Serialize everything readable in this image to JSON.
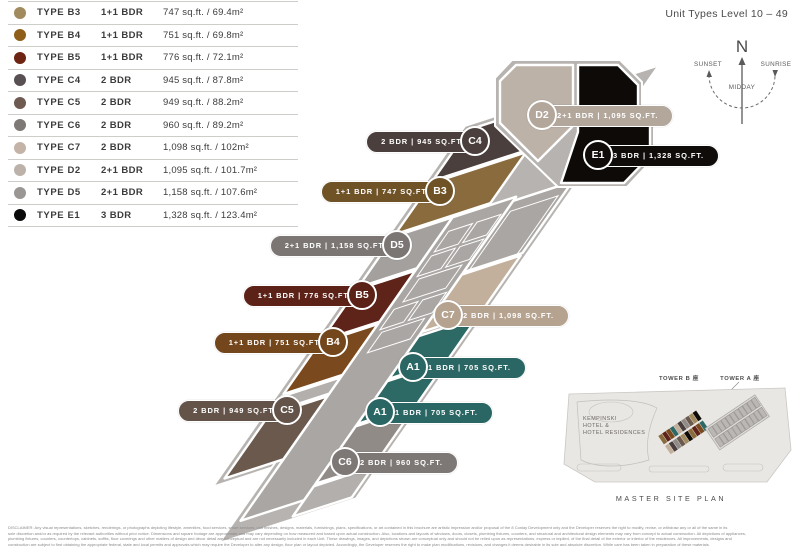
{
  "title": "Unit Types Level 10 – 49",
  "legend": {
    "rows": [
      {
        "type": "TYPE B3",
        "bdr": "1+1 BDR",
        "area": "747 sq.ft. / 69.4m²",
        "color": "#a08a5e"
      },
      {
        "type": "TYPE B4",
        "bdr": "1+1 BDR",
        "area": "751 sq.ft. / 69.8m²",
        "color": "#8f5e18"
      },
      {
        "type": "TYPE B5",
        "bdr": "1+1 BDR",
        "area": "776 sq.ft. / 72.1m²",
        "color": "#6e2413"
      },
      {
        "type": "TYPE C4",
        "bdr": "2 BDR",
        "area": "945 sq.ft. / 87.8m²",
        "color": "#585052"
      },
      {
        "type": "TYPE C5",
        "bdr": "2 BDR",
        "area": "949 sq.ft. / 88.2m²",
        "color": "#6e5a50"
      },
      {
        "type": "TYPE C6",
        "bdr": "2 BDR",
        "area": "960 sq.ft. / 89.2m²",
        "color": "#7e7876"
      },
      {
        "type": "TYPE C7",
        "bdr": "2 BDR",
        "area": "1,098 sq.ft. / 102m²",
        "color": "#c4b4a8"
      },
      {
        "type": "TYPE D2",
        "bdr": "2+1 BDR",
        "area": "1,095 sq.ft. / 101.7m²",
        "color": "#bcb2aa"
      },
      {
        "type": "TYPE D5",
        "bdr": "2+1 BDR",
        "area": "1,158 sq.ft. / 107.6m²",
        "color": "#9a9694"
      },
      {
        "type": "TYPE E1",
        "bdr": "3 BDR",
        "area": "1,328 sq.ft. / 123.4m²",
        "color": "#0a0a0a"
      }
    ]
  },
  "compass": {
    "north": "N",
    "sunset": "SUNSET",
    "sunrise": "SUNRISE",
    "midday": "MIDDAY"
  },
  "plan": {
    "outline_color": "#b7b3b0",
    "core_color": "#aaa6a3",
    "bar_pieces": [
      {
        "id": "unit-C4",
        "t0": 0,
        "t1": 62,
        "c0": 0,
        "c1": 100,
        "color": "#4a3f3c"
      },
      {
        "id": "unit-B3",
        "t0": 65,
        "t1": 127,
        "c0": 0,
        "c1": 100,
        "color": "#8a6b3e"
      },
      {
        "id": "unit-D5",
        "t0": 130,
        "t1": 192,
        "c0": 0,
        "c1": 62,
        "color": "#a3a09d"
      },
      {
        "id": "unit-B5",
        "t0": 195,
        "t1": 257,
        "c0": 0,
        "c1": 62,
        "color": "#5f2419"
      },
      {
        "id": "unit-B4",
        "t0": 260,
        "t1": 322,
        "c0": 0,
        "c1": 62,
        "color": "#7a4a1e"
      },
      {
        "id": "stair-core",
        "t0": 325,
        "t1": 345,
        "c0": 0,
        "c1": 62,
        "color": "#b3afac"
      },
      {
        "id": "unit-C5",
        "t0": 348,
        "t1": 425,
        "c0": 0,
        "c1": 62,
        "color": "#6b594d"
      },
      {
        "id": "central-core",
        "t0": 130,
        "t1": 500,
        "c0": 62,
        "c1": 129,
        "color": "#aaa6a3"
      },
      {
        "id": "core-upper-right",
        "t0": 135,
        "t1": 222,
        "c0": 129,
        "c1": 191,
        "color": "#aaa6a3"
      },
      {
        "id": "unit-C7",
        "t0": 225,
        "t1": 295,
        "c0": 129,
        "c1": 191,
        "color": "#c3b09c"
      },
      {
        "id": "unit-A1-upper",
        "t0": 300,
        "t1": 352,
        "c0": 129,
        "c1": 191,
        "color": "#2d6965"
      },
      {
        "id": "unit-A1-lower",
        "t0": 355,
        "t1": 407,
        "c0": 129,
        "c1": 191,
        "color": "#2d6965"
      },
      {
        "id": "unit-C6",
        "t0": 410,
        "t1": 480,
        "c0": 129,
        "c1": 191,
        "color": "#918b88"
      },
      {
        "id": "bar-tail",
        "t0": 483,
        "t1": 520,
        "c0": 129,
        "c1": 191,
        "color": "#b3afac"
      }
    ],
    "core_rects": [
      {
        "t0": 150,
        "t1": 175,
        "c0": 70,
        "c1": 95
      },
      {
        "t0": 150,
        "t1": 175,
        "c0": 100,
        "c1": 125
      },
      {
        "t0": 180,
        "t1": 205,
        "c0": 70,
        "c1": 95
      },
      {
        "t0": 180,
        "t1": 205,
        "c0": 100,
        "c1": 125
      },
      {
        "t0": 210,
        "t1": 238,
        "c0": 75,
        "c1": 120
      },
      {
        "t0": 245,
        "t1": 270,
        "c0": 70,
        "c1": 95
      },
      {
        "t0": 245,
        "t1": 270,
        "c0": 100,
        "c1": 125
      },
      {
        "t0": 275,
        "t1": 300,
        "c0": 75,
        "c1": 120
      },
      {
        "t0": 150,
        "t1": 222,
        "c0": 135,
        "c1": 185
      }
    ],
    "head": {
      "outline": [
        [
          512,
          60
        ],
        [
          620,
          60
        ],
        [
          642,
          82
        ],
        [
          642,
          108
        ],
        [
          654,
          120
        ],
        [
          654,
          158
        ],
        [
          627,
          187
        ],
        [
          558,
          187
        ],
        [
          495,
          126
        ],
        [
          495,
          78
        ]
      ],
      "d2": [
        [
          516,
          65
        ],
        [
          573,
          65
        ],
        [
          573,
          126
        ],
        [
          538,
          161
        ],
        [
          500,
          123
        ],
        [
          500,
          81
        ]
      ],
      "e1": [
        [
          578,
          65
        ],
        [
          618,
          65
        ],
        [
          638,
          85
        ],
        [
          638,
          110
        ],
        [
          650,
          122
        ],
        [
          650,
          156
        ],
        [
          624,
          183
        ],
        [
          561,
          183
        ],
        [
          578,
          132
        ]
      ],
      "d2_color": "#bdb2a8",
      "e1_color": "#0d0a08"
    },
    "callouts": [
      {
        "id": "C4",
        "text": "2 BDR  |  945 SQ.FT.",
        "cx": 475,
        "cy": 141,
        "side": "left",
        "color": "#4a3f3c"
      },
      {
        "id": "B3",
        "text": "1+1 BDR  |  747 SQ.FT.",
        "cx": 440,
        "cy": 191,
        "side": "left",
        "color": "#6f5226"
      },
      {
        "id": "D5",
        "text": "2+1 BDR  |  1,158 SQ.FT.",
        "cx": 397,
        "cy": 245,
        "side": "left",
        "color": "#7b7673"
      },
      {
        "id": "B5",
        "text": "1+1 BDR  |  776 SQ.FT.",
        "cx": 362,
        "cy": 295,
        "side": "left",
        "color": "#5c2218"
      },
      {
        "id": "B4",
        "text": "1+1 BDR  |  751 SQ.FT.",
        "cx": 333,
        "cy": 342,
        "side": "left",
        "color": "#74461c"
      },
      {
        "id": "C5",
        "text": "2 BDR  |  949 SQ.FT.",
        "cx": 287,
        "cy": 410,
        "side": "left",
        "color": "#635349"
      },
      {
        "id": "D2",
        "text": "2+1 BDR  |  1,095 SQ.FT.",
        "cx": 542,
        "cy": 115,
        "side": "right",
        "color": "#b3a79c"
      },
      {
        "id": "E1",
        "text": "3 BDR  |  1,328 SQ.FT.",
        "cx": 598,
        "cy": 155,
        "side": "right",
        "color": "#100c0a"
      },
      {
        "id": "C7",
        "text": "2 BDR  |  1,098 SQ.FT.",
        "cx": 448,
        "cy": 315,
        "side": "right",
        "color": "#b5a28f"
      },
      {
        "id": "A1",
        "text": "1 BDR  |  705 SQ.FT.",
        "cx": 413,
        "cy": 367,
        "side": "right",
        "color": "#2a6663"
      },
      {
        "id": "A1",
        "text": "1 BDR  |  705 SQ.FT.",
        "cx": 380,
        "cy": 412,
        "side": "right",
        "color": "#2a6663"
      },
      {
        "id": "C6",
        "text": "2 BDR  |  960 SQ.FT.",
        "cx": 345,
        "cy": 462,
        "side": "right",
        "color": "#7d7875"
      }
    ]
  },
  "site_plan": {
    "tower_b_label": "TOWER B 座",
    "tower_a_label": "TOWER A 座",
    "hotel_line1": "KEMPINSKI",
    "hotel_line2": "HOTEL &",
    "hotel_line3": "HOTEL RESIDENCES",
    "caption": "MASTER SITE PLAN",
    "tower_b_cell_colors": [
      "#8a6b3e",
      "#5f2419",
      "#7a4a1e",
      "#2d6965",
      "#c3b09c",
      "#4a3f3c",
      "#918b88",
      "#6b594d",
      "#a08a5e",
      "#0d0a08"
    ]
  },
  "disclaimer": {
    "line1": "DISCLAIMER:  Any visual representations, sketches, renderings, or photographs depicting lifestyle, amenities, food services, smart services, unit finishes, designs, materials, furnishings, plans, specifications, or art contained in this brochure are artistic impression and/or proposal of the 8 Conlay Development only and the Developer reserves the right to modify, revise, or withdraw any or all of the same in its",
    "line2": "sole discretion and/or as required by the relevant authorities without prior notice. Dimensions and square footage are approximate and may vary depending on how measured and based upon actual construction. Also, locations and layouts of windows, doors, closets, plumbing fixtures, counters, and structural and architectural design elements may vary from concept to actual construction. All depictions of appliances,",
    "line3": "plumbing fixtures, counters, countertops, cabinets, soffits, floor coverings and other matters of design and décor detail are conceptual and are not necessarily included in each Unit. These drawings, images, and depictions shown are conceptual only and should not be relied upon as representations, express or implied, of the final detail of the exterior or interior of the residences. All improvements, designs and",
    "line4": "construction are subject to first obtaining the appropriate federal, state and local permits and approvals which may require the Developer to alter any design, floor plan or layout depicted. Accordingly, the Developer reserves the right to make plan modifications, revisions, and changes it deems desirable in its sole and absolute discretion. While care has been taken in preparation of these materials."
  }
}
